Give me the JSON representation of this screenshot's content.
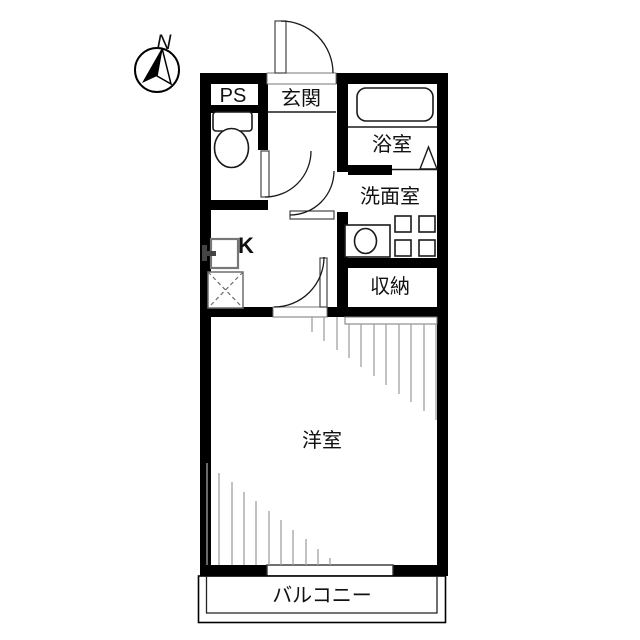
{
  "title": "floor-plan",
  "compass": {
    "north_label": "N"
  },
  "rooms": {
    "pipe_space": "PS",
    "entrance": "玄関",
    "bathroom": "浴室",
    "washroom": "洗面室",
    "kitchen": "K",
    "storage": "収納",
    "western_room": "洋室",
    "balcony": "バルコニー"
  },
  "colors": {
    "wall": "#000000",
    "background": "#ffffff",
    "hatch": "#a2a2a2"
  }
}
